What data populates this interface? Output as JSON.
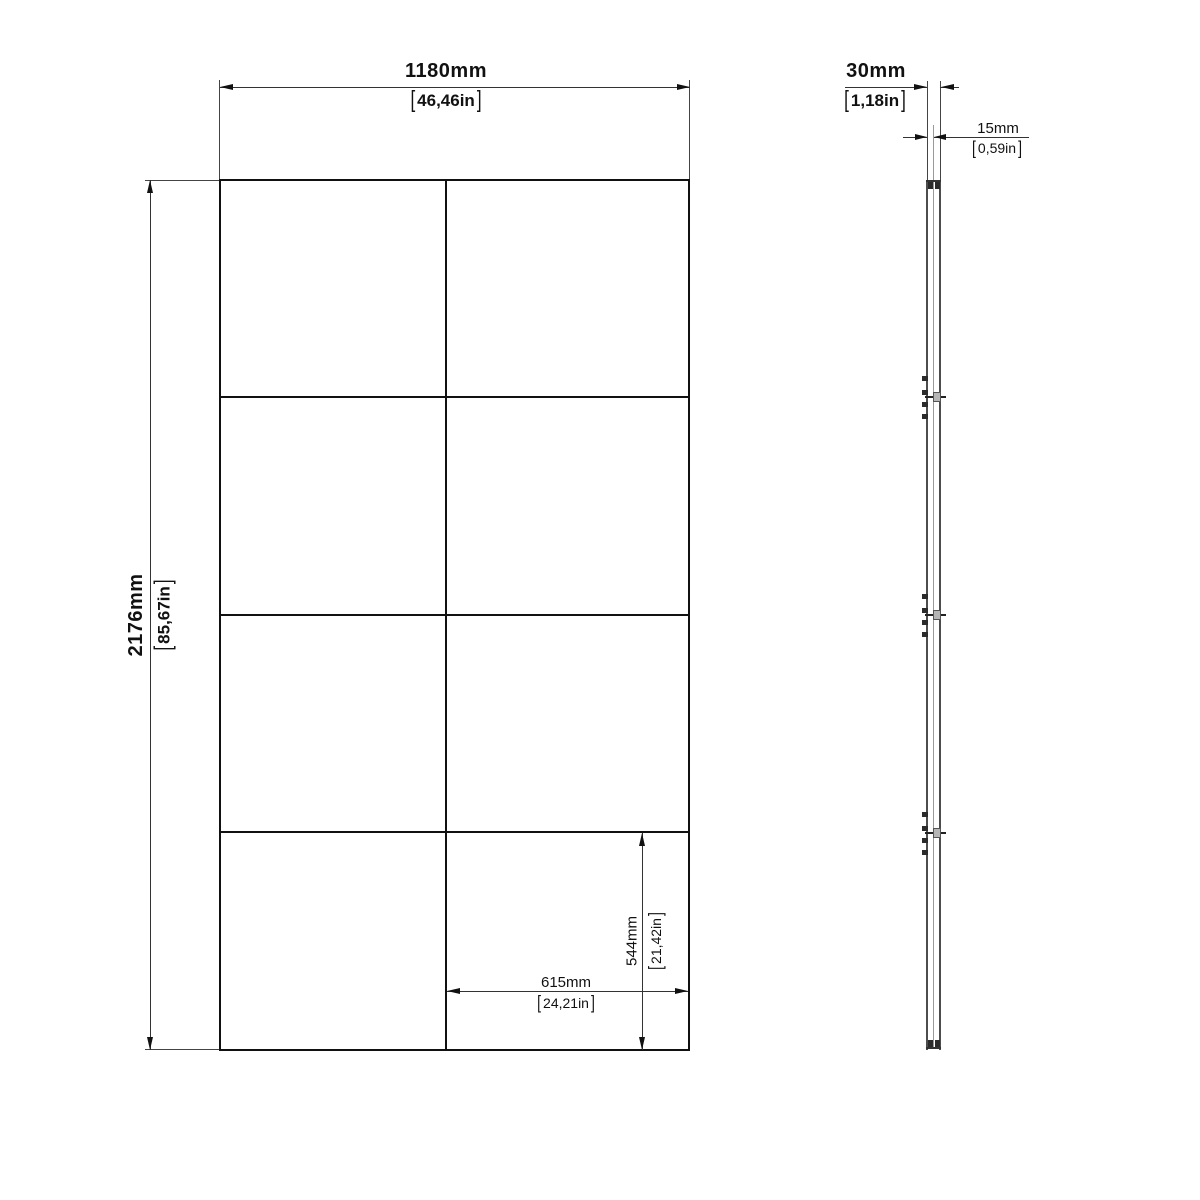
{
  "drawing": {
    "brackets": {
      "open": "[",
      "close": "]"
    },
    "front_view": {
      "width": {
        "mm": "1180mm",
        "in": "46,46in"
      },
      "height": {
        "mm": "2176mm",
        "in": "85,67in"
      },
      "cell_width": {
        "mm": "615mm",
        "in": "24,21in"
      },
      "cell_height": {
        "mm": "544mm",
        "in": "21,42in"
      }
    },
    "side_view": {
      "thickness": {
        "mm": "30mm",
        "in": "1,18in"
      },
      "half_thickness": {
        "mm": "15mm",
        "in": "0,59in"
      }
    }
  }
}
